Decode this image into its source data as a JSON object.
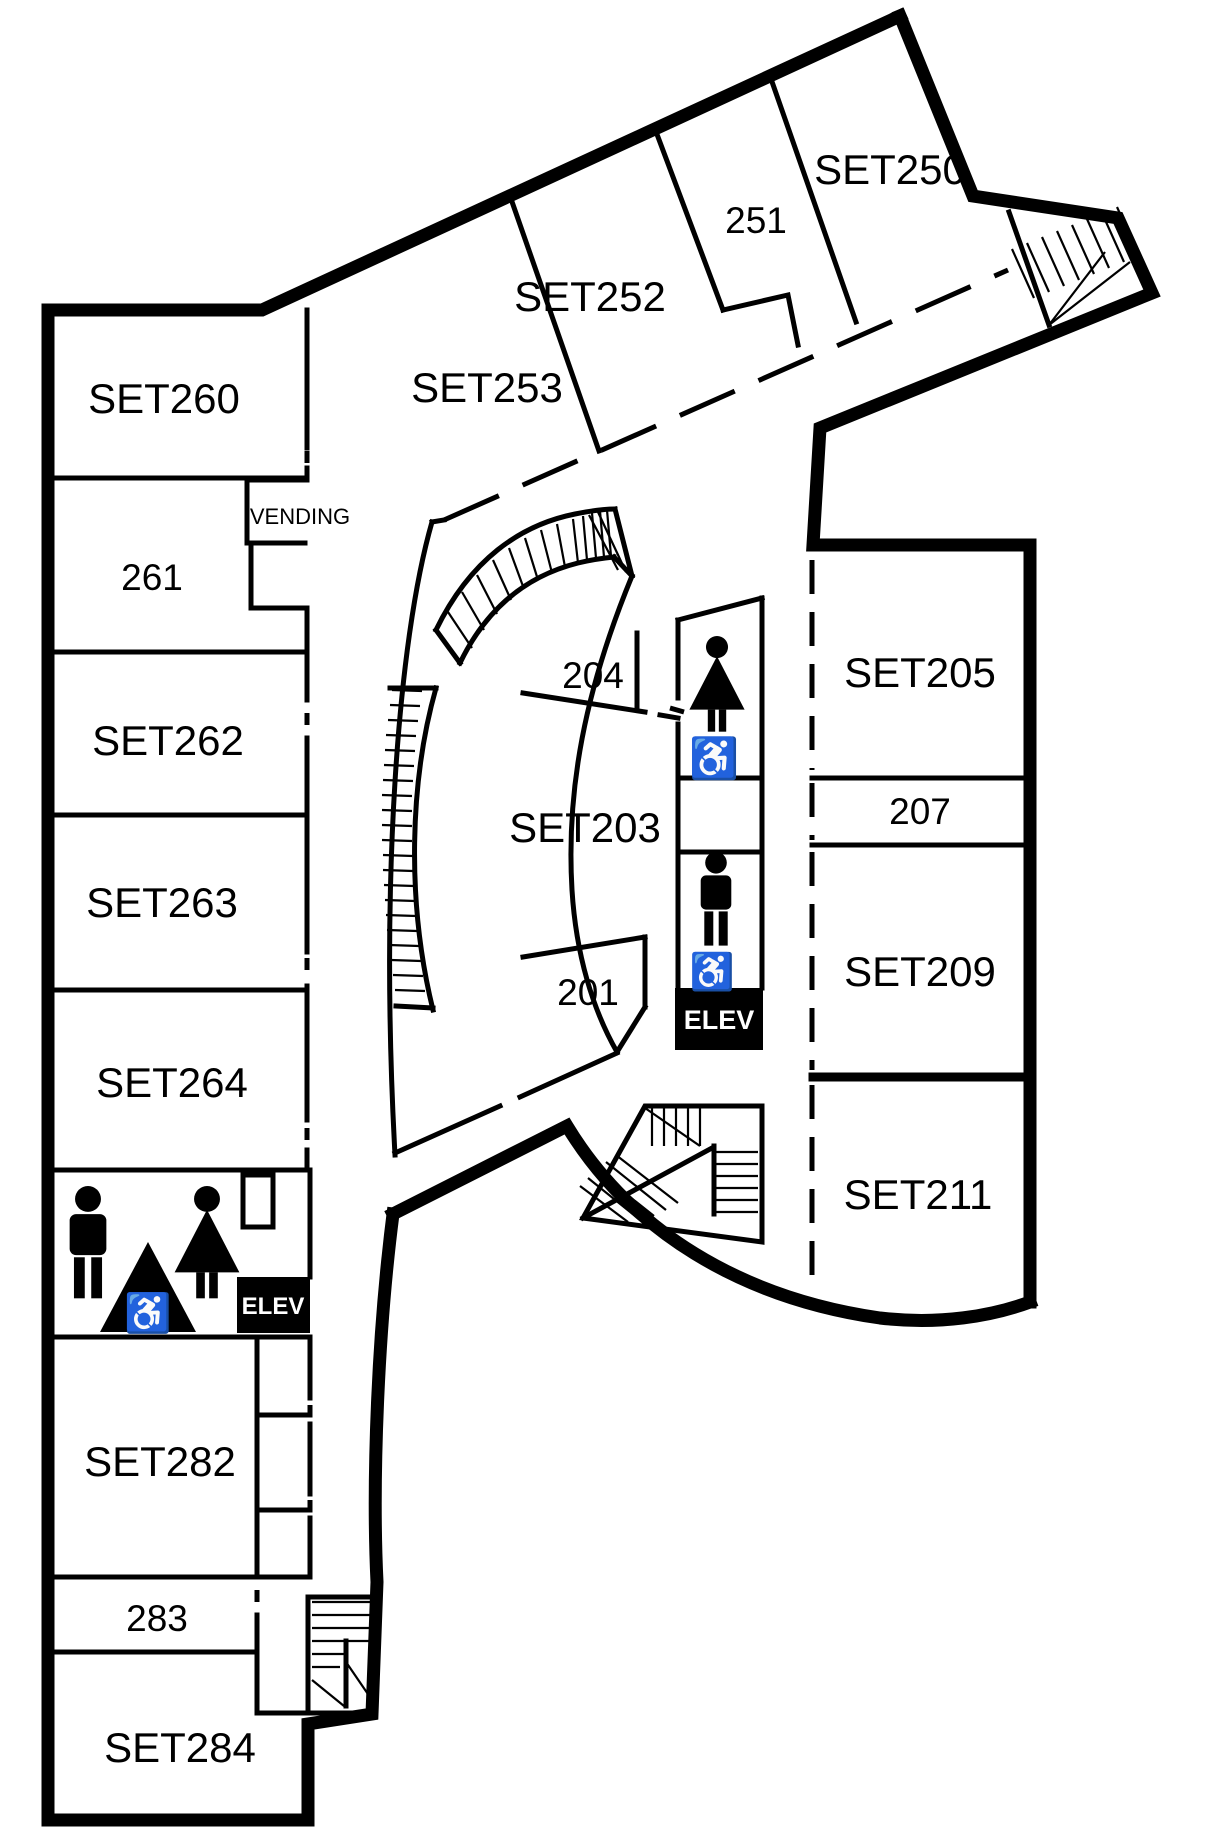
{
  "title": "Second floor plan",
  "colors": {
    "wall": "#000000",
    "background": "#ffffff",
    "elevator_bg": "#000000",
    "elevator_text": "#ffffff"
  },
  "rooms": {
    "set250": {
      "label": "SET250"
    },
    "r251": {
      "label": "251"
    },
    "set252": {
      "label": "SET252"
    },
    "set253": {
      "label": "SET253"
    },
    "set260": {
      "label": "SET260"
    },
    "r261": {
      "label": "261"
    },
    "set262": {
      "label": "SET262"
    },
    "set263": {
      "label": "SET263"
    },
    "set264": {
      "label": "SET264"
    },
    "r204": {
      "label": "204"
    },
    "set203": {
      "label": "SET203"
    },
    "r201": {
      "label": "201"
    },
    "set205": {
      "label": "SET205"
    },
    "r207": {
      "label": "207"
    },
    "set209": {
      "label": "SET209"
    },
    "set211": {
      "label": "SET211"
    },
    "set282": {
      "label": "SET282"
    },
    "r283": {
      "label": "283"
    },
    "set284": {
      "label": "SET284"
    }
  },
  "areas": {
    "vending": {
      "label": "VENDING"
    }
  },
  "elevators": {
    "center": {
      "label": "ELEV"
    },
    "west": {
      "label": "ELEV"
    }
  },
  "icons": {
    "wheelchair": {
      "name": "wheelchair-icon",
      "glyph": "♿"
    },
    "women": {
      "name": "women-restroom-icon"
    },
    "men": {
      "name": "men-restroom-icon"
    }
  }
}
